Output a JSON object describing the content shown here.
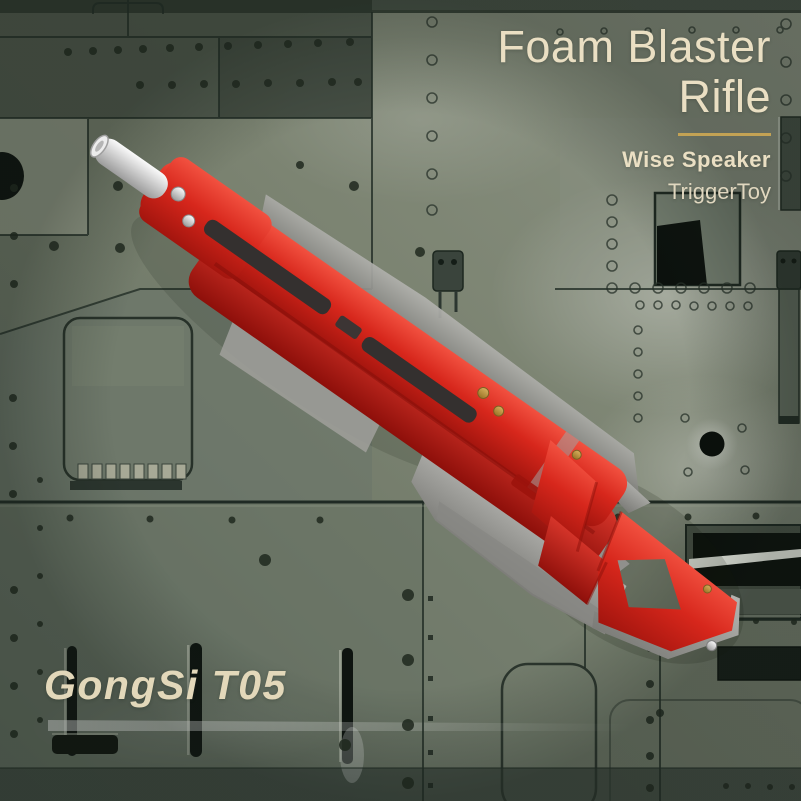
{
  "product_card": {
    "title_line1": "Foam Blaster",
    "title_line2": "Rifle",
    "brand": "Wise Speaker",
    "maker": "TriggerToy",
    "model": "GongSi T05"
  },
  "colors": {
    "text_cream": "#eadfc3",
    "accent_gold": "#c3a254",
    "blaster_red": "#d2261c",
    "blaster_gray": "#8f8f8b",
    "muzzle_silver": "#e6e6e6",
    "panel_green": "#78816f"
  }
}
